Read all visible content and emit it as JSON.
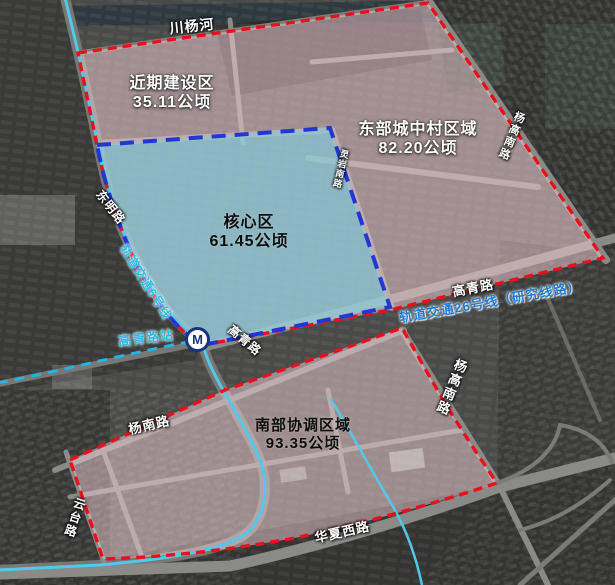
{
  "zones": [
    {
      "name": "近期建设区",
      "area": "35.11公顷"
    },
    {
      "name": "东部城中村区域",
      "area": "82.20公顷"
    },
    {
      "name": "核心区",
      "area": "61.45公顷"
    },
    {
      "name": "南部协调区域",
      "area": "93.35公顷"
    }
  ],
  "river": {
    "name": "川杨河"
  },
  "roads": {
    "dongming": "东明路",
    "gaoqing_station_side": "高青路",
    "gaoqing_east": "高青路",
    "yangnan": "杨南路",
    "yuntai": "云台路",
    "huaxia_west": "华夏西路",
    "yanggao_south_mid": "杨高南路",
    "yanggao_south_north": "杨高南路",
    "lingyan_south": "灵岩南路"
  },
  "metro": {
    "station": "高青路站",
    "logo": "M",
    "line6": "轨道交通6号线",
    "line26": "轨道交通26号线（研究线路）"
  },
  "colors": {
    "zone_pink": "#f0cdd3",
    "zone_core": "#7ecfdf",
    "boundary_red": "#e8101c",
    "boundary_blue": "#2236d4",
    "metro_cyan": "#52c9e9",
    "line26_text": "#1b7ad0",
    "station_text": "#2fb9e2"
  }
}
